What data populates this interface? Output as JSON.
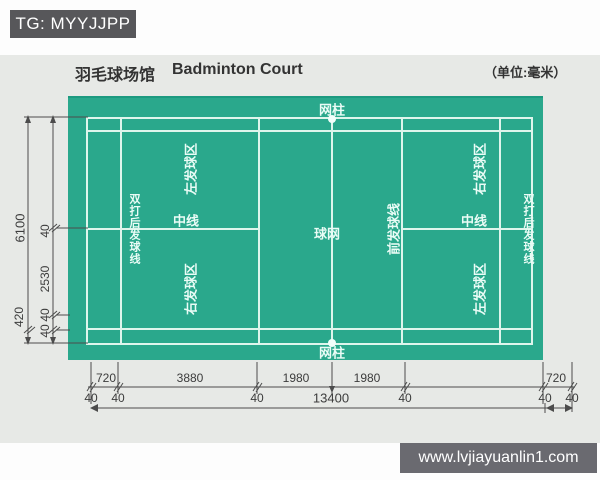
{
  "badge": {
    "text": "TG: MYYJJPP"
  },
  "header": {
    "title_zh": "羽毛球场馆",
    "title_en": "Badminton Court",
    "unit": "（单位:毫米）"
  },
  "court": {
    "net_post": "网柱",
    "net": "球网",
    "center_line": "中线",
    "left_service_area": "左发球区",
    "right_service_area": "右发球区",
    "doubles_long_service_line": "双打后发球线",
    "short_service_line": "前发球线"
  },
  "dimensions": {
    "left_labels": [
      "6100",
      "40",
      "2530",
      "420",
      "40",
      "40"
    ],
    "bottom_segments": [
      "720",
      "3880",
      "1980",
      "1980",
      "720"
    ],
    "bottom_line_widths": [
      "40",
      "40",
      "40",
      "40",
      "40",
      "40"
    ],
    "total_length": "13400"
  },
  "footer": {
    "url": "www.lvjiayuanlin1.com"
  },
  "colors": {
    "court_green": "#2aa88c",
    "court_line": "#def5ec",
    "badge_bg": "#57575a",
    "footer_bg": "#6a6a70",
    "panel_bg": "#e7e9e6",
    "dimension": "#4c4c4c"
  }
}
